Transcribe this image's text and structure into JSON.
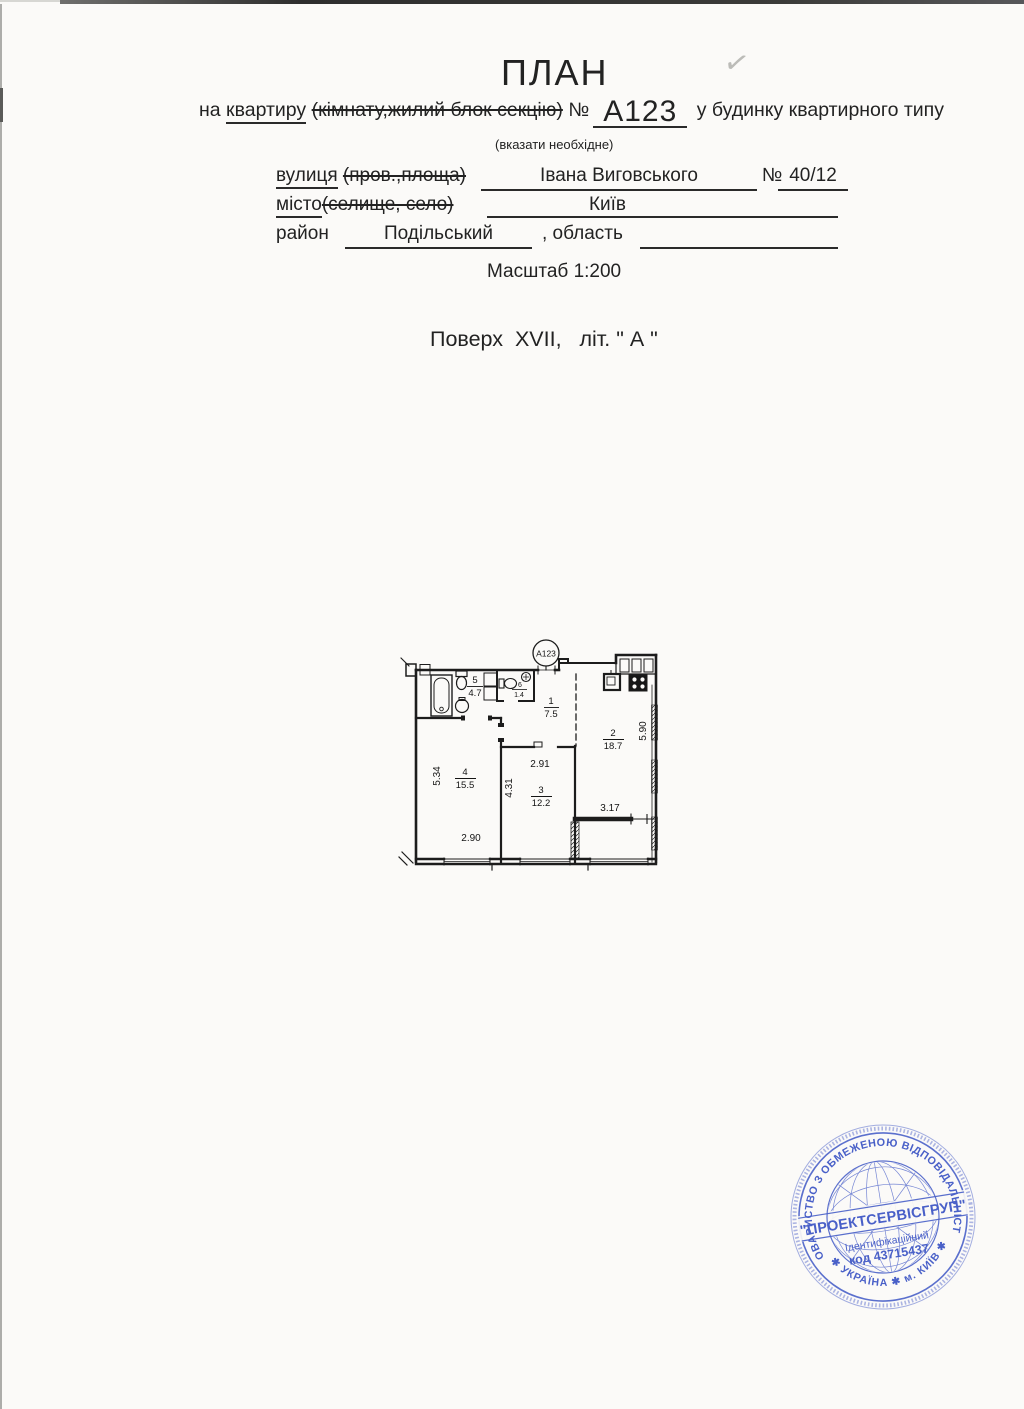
{
  "document": {
    "title": "ПЛАН",
    "line1": {
      "prefix": "на ",
      "underlined": "квартиру",
      "struck": "(кімнату,жилий блок секцію)",
      "number_sign": "№",
      "apartment_number": "А123",
      "suffix": "у будинку квартирного типу"
    },
    "note": "(вказати необхідне)",
    "address": {
      "street_label": "вулиця",
      "street_struck": "(пров.,площа)",
      "street_value": "Івана Виговського",
      "building_sign": "№",
      "building_value": "40/12",
      "city_label": "місто",
      "city_struck": "(селище, село)",
      "city_value": "Київ",
      "district_label": "район",
      "district_value": "Подільський",
      "region_label": ", область",
      "region_value": ""
    },
    "scale": "Масштаб 1:200",
    "floor_line": "Поверх  XVII,   літ. \" А \"",
    "checkmark": "✓"
  },
  "plan": {
    "apartment_badge": "А123",
    "rooms": [
      {
        "number": "1",
        "area": "7.5"
      },
      {
        "number": "2",
        "area": "18.7"
      },
      {
        "number": "3",
        "area": "12.2"
      },
      {
        "number": "4",
        "area": "15.5"
      },
      {
        "number": "5",
        "area": "4.7"
      },
      {
        "number": "6",
        "area": "1.4"
      }
    ],
    "dims": {
      "d290": "2.90",
      "d291": "2.91",
      "d317": "3.17",
      "d431": "4.31",
      "d534": "5.34",
      "d590": "5.90"
    }
  },
  "stamp": {
    "arc_top": "ТОВАРИСТВО З ОБМЕЖЕНОЮ ВІДПОВІДАЛЬНІСТЮ",
    "arc_bottom": "✱ УКРАЇНА ✱ м. КИЇВ ✱",
    "company": "\"ПРОЕКТСЕРВІСГРУП\"",
    "id_label": "Ідентифікаційний",
    "id_code": "код 43715437",
    "color": "#3a53c4"
  },
  "colors": {
    "ink": "#1d1d1d",
    "page": "#fbfaf8",
    "stamp_blue": "#3a53c4"
  }
}
